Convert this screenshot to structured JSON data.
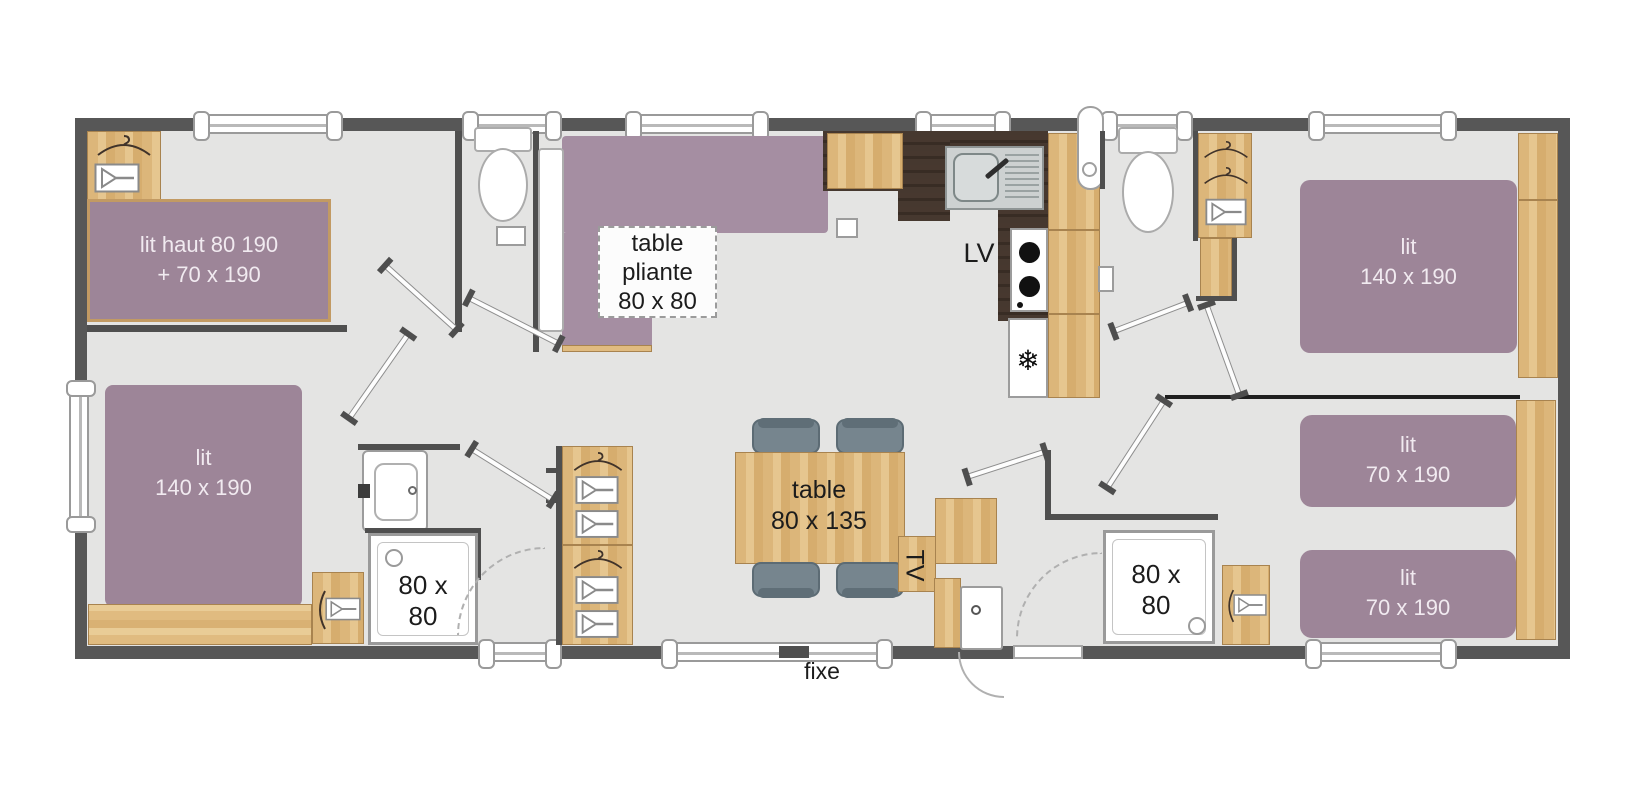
{
  "colors": {
    "wall": "#575757",
    "floor": "#e4e4e3",
    "wood": "#ddb87e",
    "bed_purple": "#9d8598",
    "kitchen_counter_dark": "#44362d",
    "chair_gray": "#76858e"
  },
  "icons": {
    "fridge_snowflake": "❄",
    "hanger": "hanger-icon",
    "shelf": "shelf-icon"
  },
  "labels": {
    "bunk_bed": {
      "line1": "lit haut 80 190",
      "line2": "+ 70 x 190"
    },
    "bed_left": {
      "line1": "lit",
      "line2": "140 x 190"
    },
    "folding_table": {
      "line1": "table",
      "line2": "pliante",
      "line3": "80 x 80"
    },
    "dishwasher": "LV",
    "shower_left": {
      "line1": "80 x",
      "line2": "80"
    },
    "dining_table": {
      "line1": "table",
      "line2": "80 x 135"
    },
    "tv": "TV",
    "shower_right": {
      "line1": "80 x",
      "line2": "80"
    },
    "bed_right_large": {
      "line1": "lit",
      "line2": "140 x 190"
    },
    "bed_right_single_top": {
      "line1": "lit",
      "line2": "70 x 190"
    },
    "bed_right_single_bottom": {
      "line1": "lit",
      "line2": "70 x 190"
    },
    "window_fixed": "fixe"
  }
}
